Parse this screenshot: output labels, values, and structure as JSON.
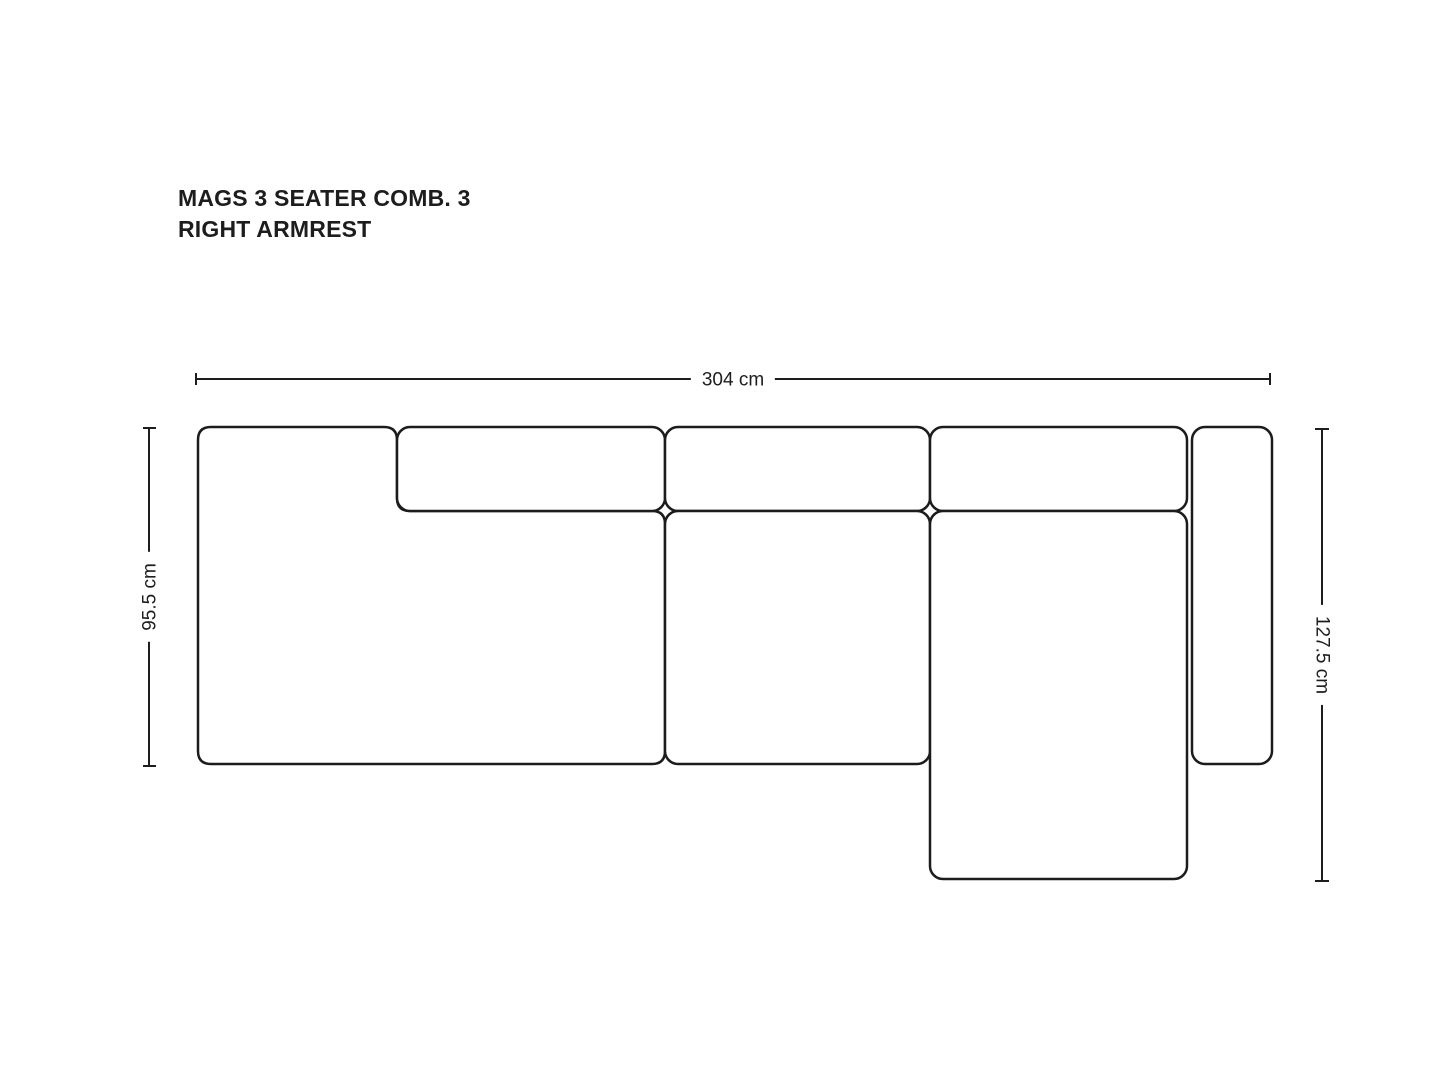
{
  "title": {
    "line1": "MAGS 3 SEATER COMB. 3",
    "line2": "RIGHT ARMREST"
  },
  "dimensions": {
    "total_width": "304 cm",
    "left_depth": "95.5 cm",
    "right_depth": "127.5 cm"
  },
  "colors": {
    "outline": "#1c1c1c",
    "text": "#1d1d1d",
    "background": "#ffffff"
  }
}
